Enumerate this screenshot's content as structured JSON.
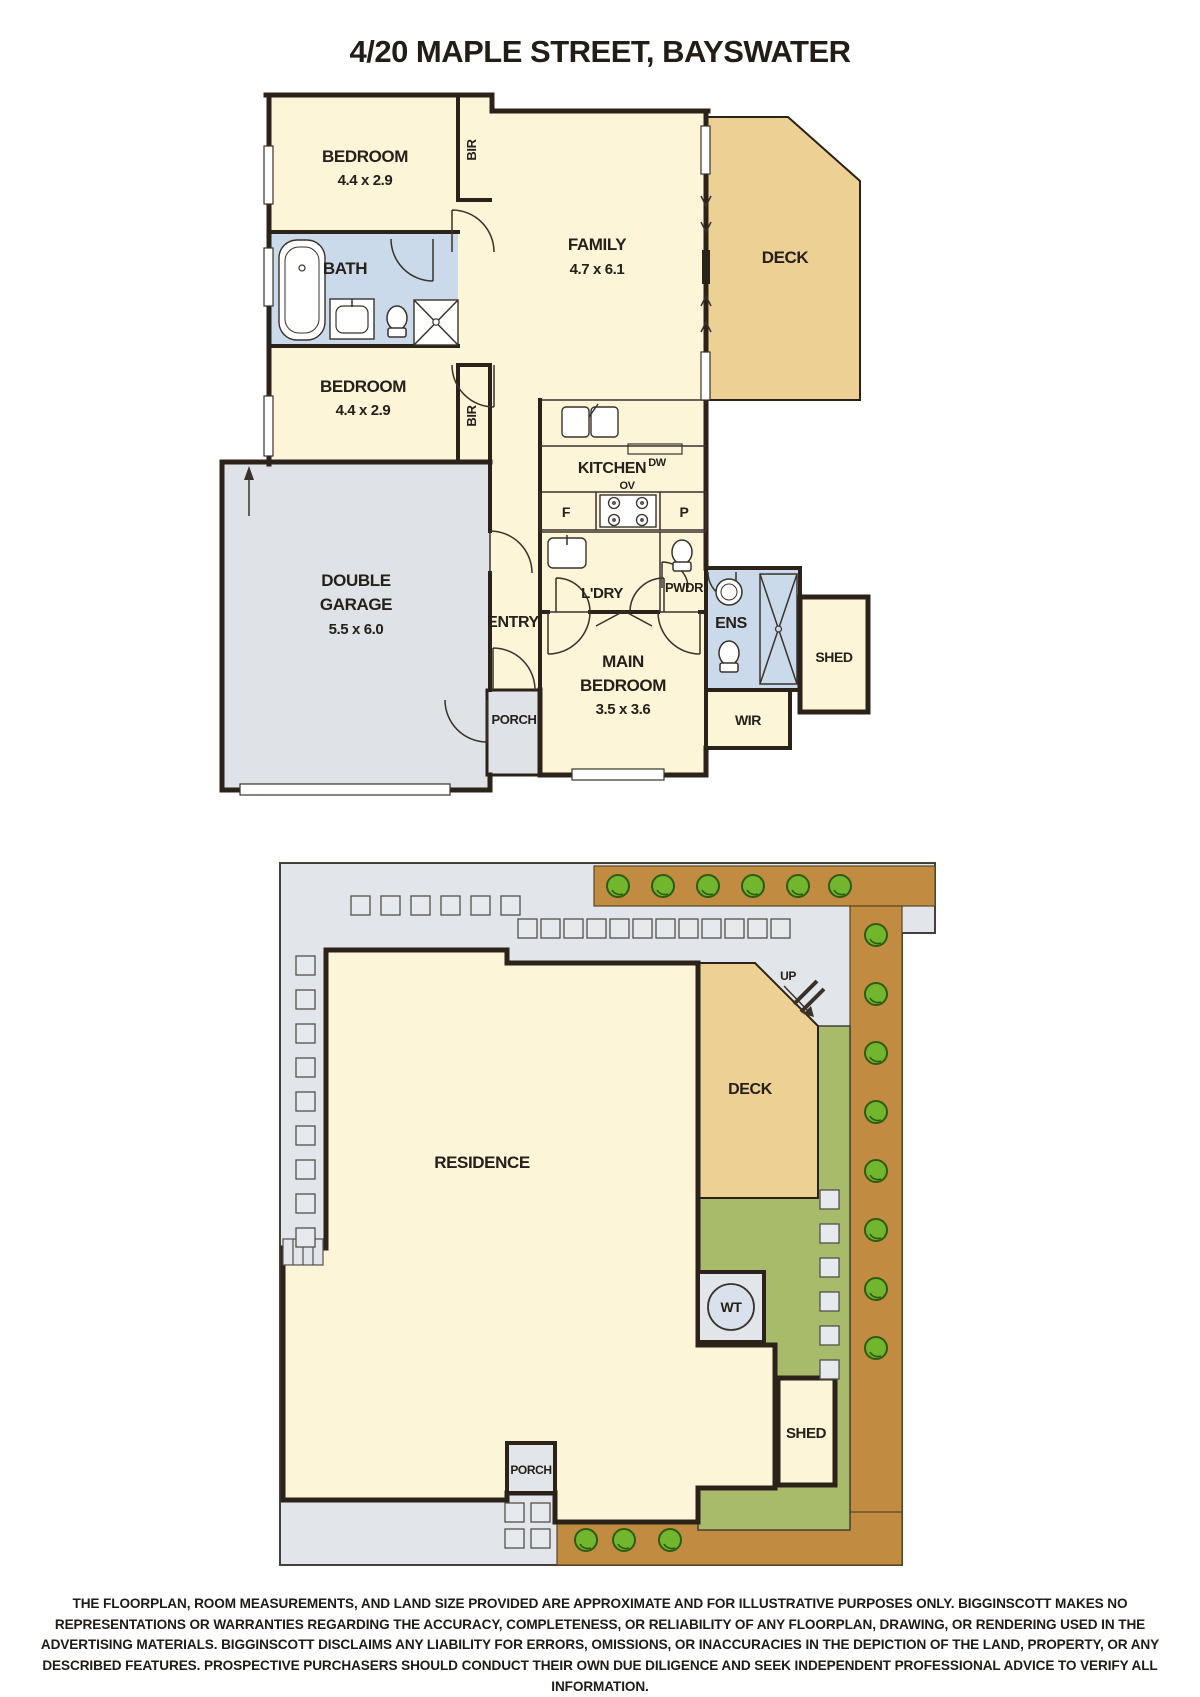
{
  "title": "4/20 MAPLE STREET, BAYSWATER",
  "floorplan": {
    "bedroom1": {
      "name": "BEDROOM",
      "dims": "4.4 x 2.9"
    },
    "bedroom2": {
      "name": "BEDROOM",
      "dims": "4.4 x 2.9"
    },
    "bir1": "BIR",
    "bir2": "BIR",
    "bath": "BATH",
    "family": {
      "name": "FAMILY",
      "dims": "4.7 x 6.1"
    },
    "deck": "DECK",
    "kitchen": {
      "name": "KITCHEN",
      "dishwasher": "DW",
      "oven": "OV",
      "fridge": "F",
      "pantry": "P"
    },
    "laundry": "L'DRY",
    "powder": "PWDR",
    "garage": {
      "line1": "DOUBLE",
      "line2": "GARAGE",
      "dims": "5.5 x 6.0"
    },
    "entry": "ENTRY",
    "porch": "PORCH",
    "main_bedroom": {
      "line1": "MAIN",
      "line2": "BEDROOM",
      "dims": "3.5 x 3.6"
    },
    "ensuite": "ENS",
    "wir": "WIR",
    "shed": "SHED"
  },
  "siteplan": {
    "residence": "RESIDENCE",
    "deck": "DECK",
    "up": "UP",
    "water_tank": "WT",
    "shed": "SHED",
    "porch": "PORCH"
  },
  "disclaimer": "THE FLOORPLAN, ROOM MEASUREMENTS, AND LAND SIZE PROVIDED ARE APPROXIMATE AND FOR ILLUSTRATIVE PURPOSES ONLY. BIGGINSCOTT MAKES NO REPRESENTATIONS OR WARRANTIES REGARDING THE ACCURACY, COMPLETENESS, OR RELIABILITY OF ANY FLOORPLAN, DRAWING, OR RENDERING USED IN THE ADVERTISING MATERIALS. BIGGINSCOTT DISCLAIMS ANY LIABILITY FOR ERRORS, OMISSIONS, OR INACCURACIES IN THE DEPICTION OF THE LAND, PROPERTY, OR ANY DESCRIBED FEATURES. PROSPECTIVE PURCHASERS SHOULD CONDUCT THEIR OWN DUE DILIGENCE AND SEEK INDEPENDENT PROFESSIONAL ADVICE TO VERIFY ALL INFORMATION.",
  "colors": {
    "room": "#FCF5D7",
    "deck": "#ECD094",
    "wet": "#CBDAEA",
    "garage": "#DFE2E6",
    "wall": "#2B2219",
    "paving": "#E2E5E9",
    "lawn": "#A8BB6B",
    "garden": "#C18C41",
    "bush": "#72B62E"
  }
}
